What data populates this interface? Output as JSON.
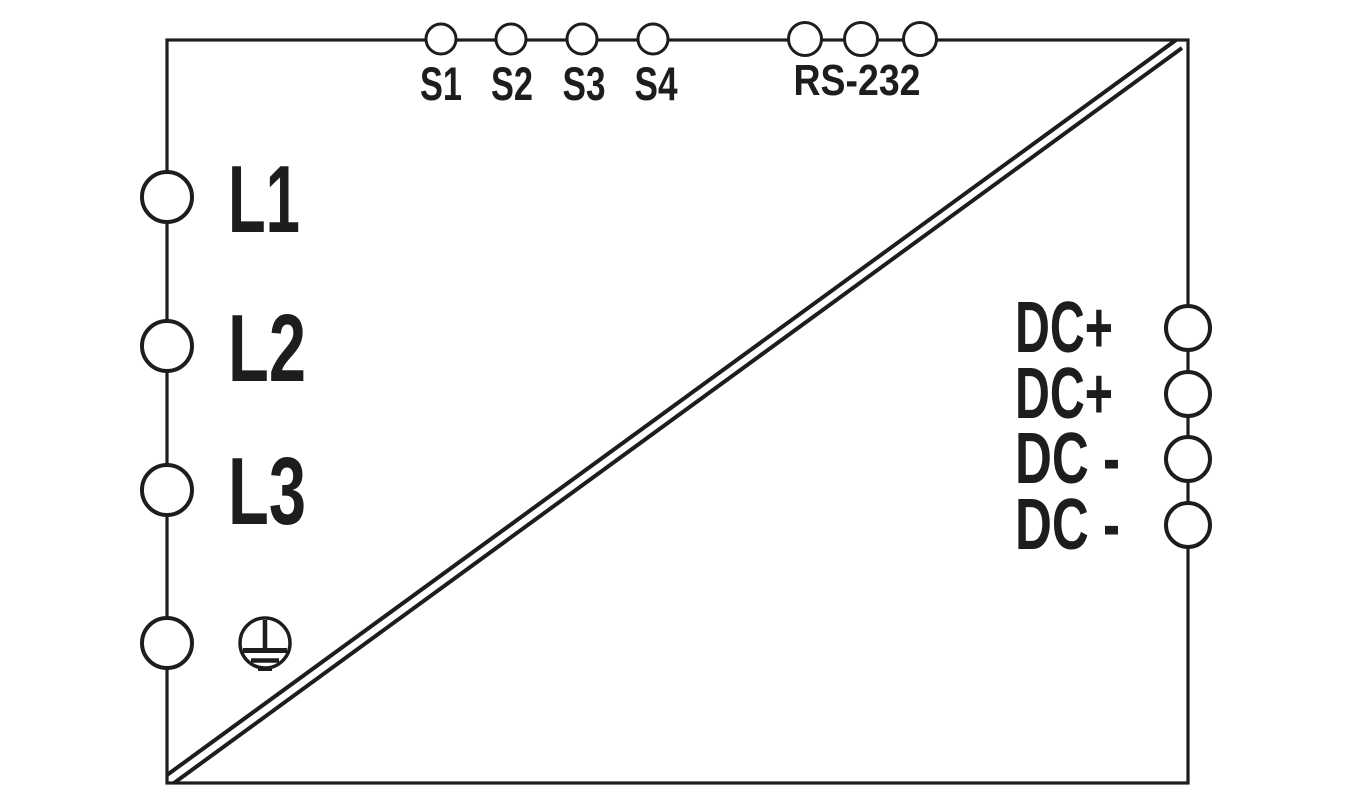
{
  "colors": {
    "line": "#1d1d1b",
    "text": "#1d1d1b",
    "terminal_fill": "#ffffff",
    "background": "#ffffff"
  },
  "diagram": {
    "kind": "power-supply-connection-diagram",
    "isolation_separator": "double-diagonal-line"
  },
  "terminals": {
    "top_switches": [
      "S1",
      "S2",
      "S3",
      "S4"
    ],
    "rs232_label": "RS-232",
    "ac_input_labels": [
      "L1",
      "L2",
      "L3"
    ],
    "ground_icon": "protective-earth-icon",
    "dc_output_labels": [
      "DC+",
      "DC+",
      "DC -",
      "DC -"
    ]
  }
}
